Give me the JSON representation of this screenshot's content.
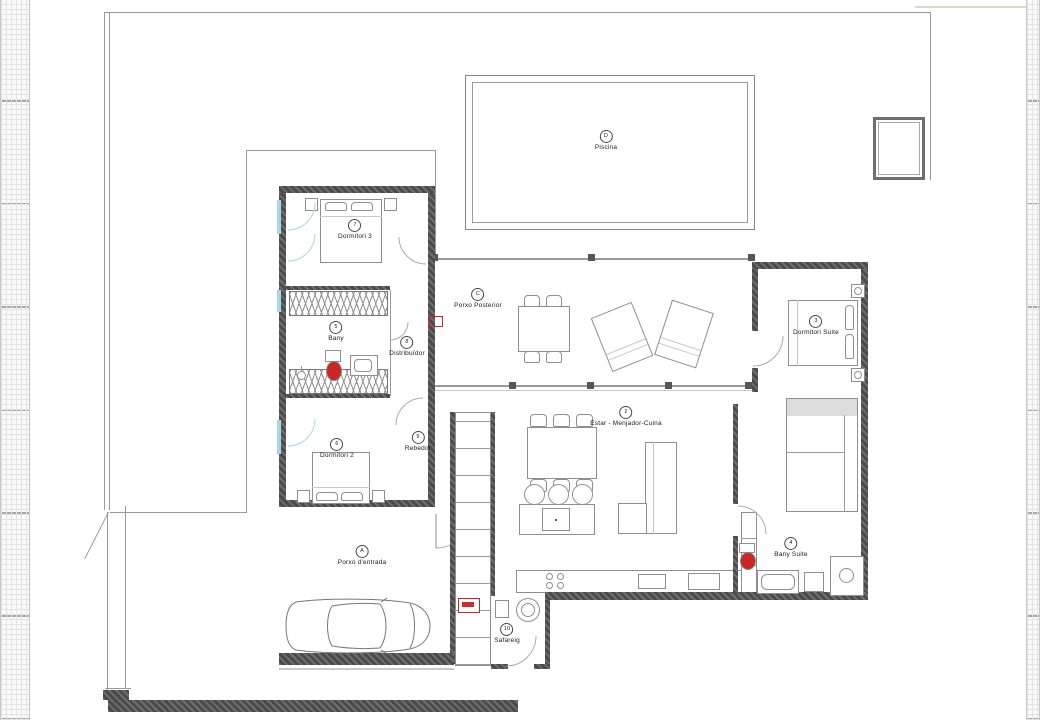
{
  "rooms": [
    {
      "code": "D",
      "label": "Piscina"
    },
    {
      "code": "7",
      "label": "Dormitori 3"
    },
    {
      "code": "C",
      "label": "Porxo Posterior"
    },
    {
      "code": "5",
      "label": "Bany"
    },
    {
      "code": "8",
      "label": "Distribuïdor"
    },
    {
      "code": "3",
      "label": "Dormitori Suite"
    },
    {
      "code": "2",
      "label": "Estar -  Menjador-Cuina"
    },
    {
      "code": "6",
      "label": "Dormitori 2"
    },
    {
      "code": "9",
      "label": "Rebedor"
    },
    {
      "code": "A",
      "label": "Porxo d'entrada"
    },
    {
      "code": "4",
      "label": "Bany Suite"
    },
    {
      "code": "10",
      "label": "Safareig"
    }
  ],
  "colors": {
    "wall": "#4b4b4b",
    "thin_line": "#9a9a9a",
    "fixture_red": "#c62828",
    "window_blue": "#a9d6e6",
    "site_green": "#cfe0c4"
  },
  "icons": {
    "car": "car-top-view",
    "washer": "circle-drum",
    "shower": "circle-head",
    "toilet": "red-bowl"
  }
}
